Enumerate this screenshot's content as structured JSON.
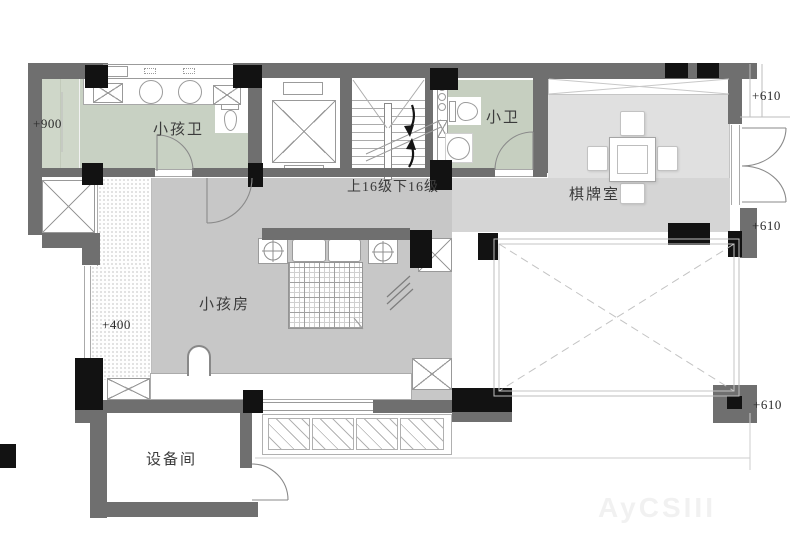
{
  "plan": {
    "type": "residential-floor-plan",
    "rooms": {
      "kids_bath": {
        "label": "小孩卫"
      },
      "small_bath": {
        "label": "小卫"
      },
      "chess_room": {
        "label": "棋牌室"
      },
      "kids_room": {
        "label": "小孩房"
      },
      "equipment_room": {
        "label": "设备间"
      }
    },
    "stairs": {
      "note": "上16级下16级"
    },
    "elevations": {
      "kids_bath_level": "+900",
      "terrace_level": "+400",
      "right_top": "+610",
      "right_mid": "+610",
      "right_bottom": "+610"
    },
    "colors": {
      "wall": "#6f6f6f",
      "column": "#121212",
      "bath_floor": "#c8d1c3",
      "kids_room_floor": "#c7c7c7",
      "corridor_floor": "#d5d5d5",
      "chess_room_floor": "#e0e0e0"
    },
    "watermark": "AyCSIII"
  }
}
